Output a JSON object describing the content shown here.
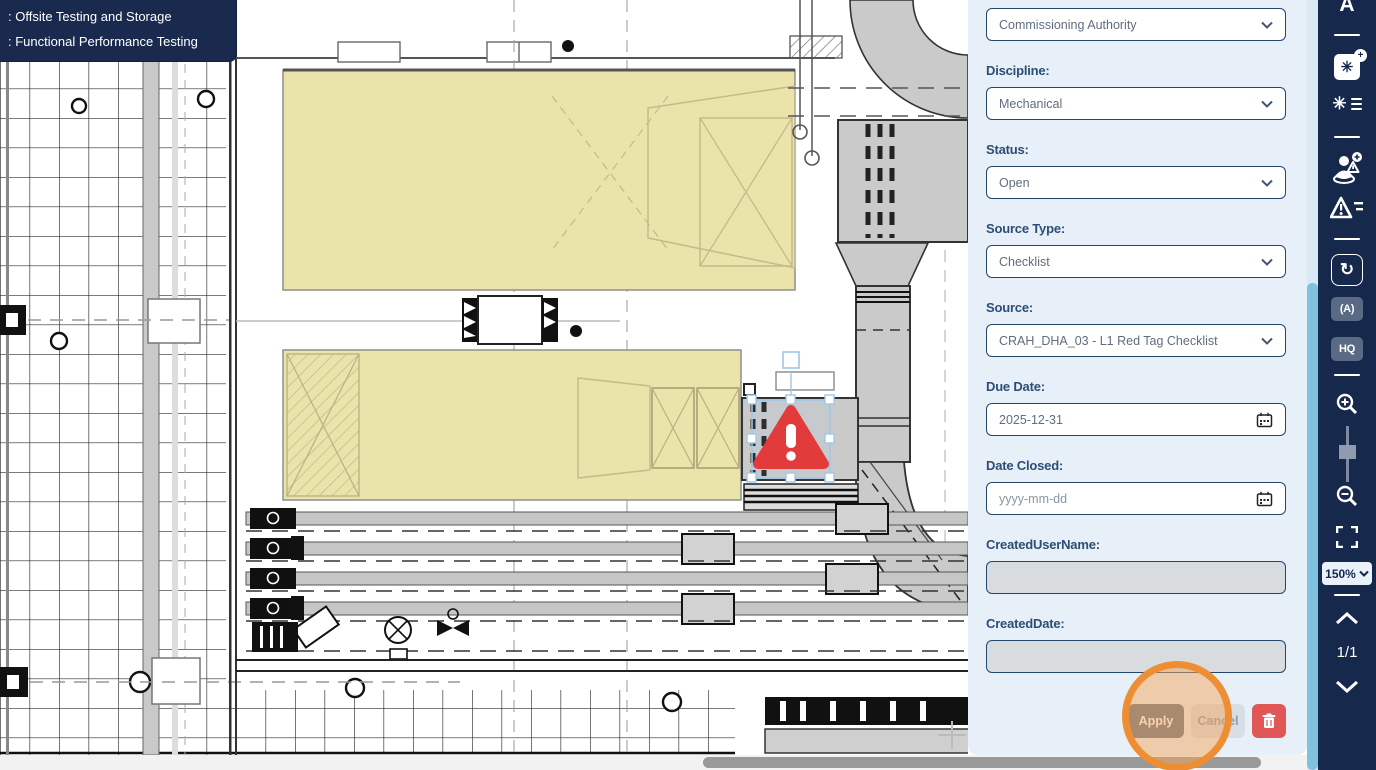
{
  "tooltip": {
    "line1": ": Offsite Testing and Storage",
    "line2": ": Functional Performance Testing"
  },
  "issue_panel": {
    "fields": {
      "responsible_party": {
        "value": "Commissioning Authority"
      },
      "discipline": {
        "label": "Discipline:",
        "value": "Mechanical"
      },
      "status": {
        "label": "Status:",
        "value": "Open"
      },
      "source_type": {
        "label": "Source Type:",
        "value": "Checklist"
      },
      "source": {
        "label": "Source:",
        "value": "CRAH_DHA_03 - L1 Red Tag Checklist"
      },
      "due_date": {
        "label": "Due Date:",
        "value": "2025-12-31"
      },
      "date_closed": {
        "label": "Date Closed:",
        "placeholder": "yyyy-mm-dd"
      },
      "created_user_name": {
        "label": "CreatedUserName:",
        "value": ""
      },
      "created_date": {
        "label": "CreatedDate:",
        "value": ""
      }
    },
    "buttons": {
      "apply": "Apply",
      "cancel": "Cancel"
    }
  },
  "toolbar": {
    "text_tool_label": "A",
    "auto_fit_label": "(A)",
    "hq_label": "HQ",
    "zoom_level": "150%",
    "page_indicator": "1/1"
  },
  "icons": {
    "fan_glyph": "✳",
    "refresh_glyph": "↻",
    "plus_badge": "+",
    "warning_glyph": "!"
  },
  "colors": {
    "toolbar_bg": "#16294d",
    "panel_bg": "#e7f0f8",
    "highlight_orange": "#ee8e33",
    "marker_red": "#e23b3b",
    "zone_yellow": "#eae3aa",
    "scrollbar_cyan": "#7fc2e0"
  }
}
